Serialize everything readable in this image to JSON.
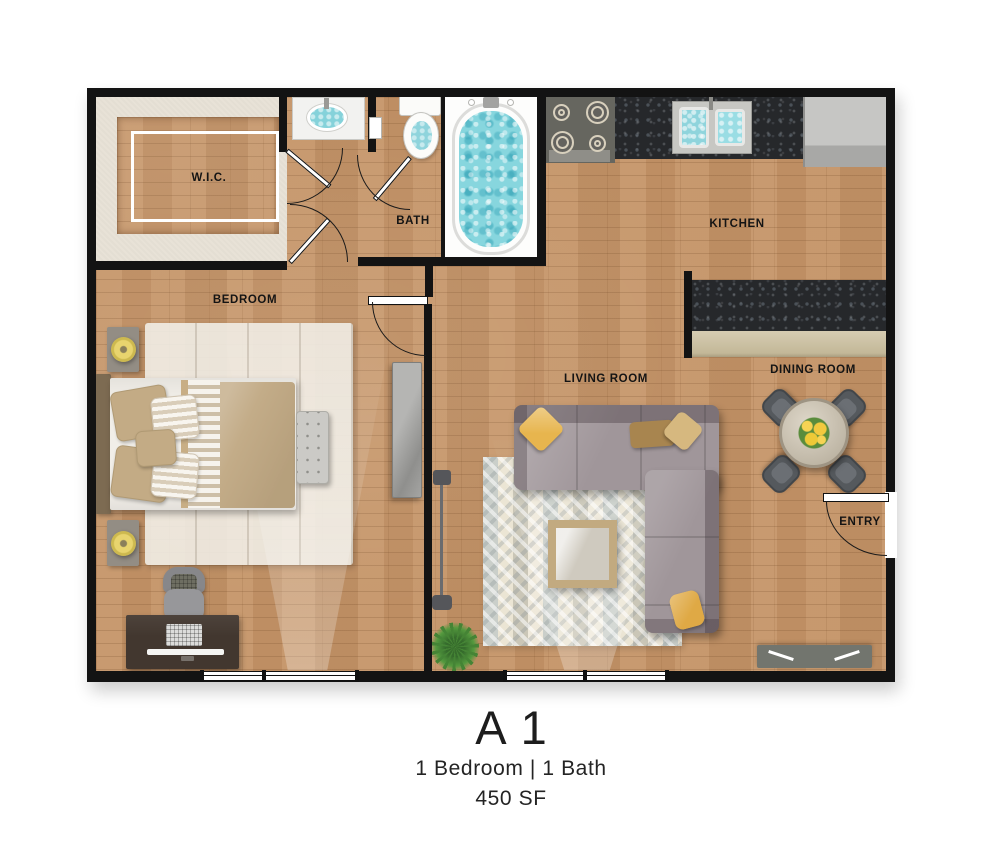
{
  "floorplan": {
    "title": "A1",
    "subtitle": "1 Bedroom | 1 Bath",
    "area": "450 SF",
    "rooms": {
      "wic": "W.I.C.",
      "bath": "BATH",
      "kitchen": "KITCHEN",
      "bedroom": "BEDROOM",
      "living_room": "LIVING ROOM",
      "dining_room": "DINING ROOM",
      "entry": "ENTRY"
    },
    "colors": {
      "wall": "#131313",
      "wood_floor": "#c49468",
      "closet_carpet": "#e8e2d7",
      "granite_counter": "#26282b",
      "bar_front": "#cdc3a8",
      "water": "#87d6de",
      "sofa": "#a0969a",
      "accent_pillow": "#e7b54e",
      "living_rug": "#e9e3d0",
      "lamp": "#e8d46e",
      "plant": "#478a33"
    },
    "furniture": [
      "bed",
      "nightstands",
      "table-lamps",
      "bench",
      "dresser",
      "desk",
      "desk-chair",
      "floor-lamp",
      "plant",
      "sectional-sofa",
      "coffee-table",
      "tv-console",
      "dining-table",
      "dining-chairs",
      "flower-centerpiece",
      "refrigerator",
      "stove",
      "kitchen-sink",
      "breakfast-bar",
      "bathtub",
      "toilet",
      "vanity-sink"
    ]
  }
}
